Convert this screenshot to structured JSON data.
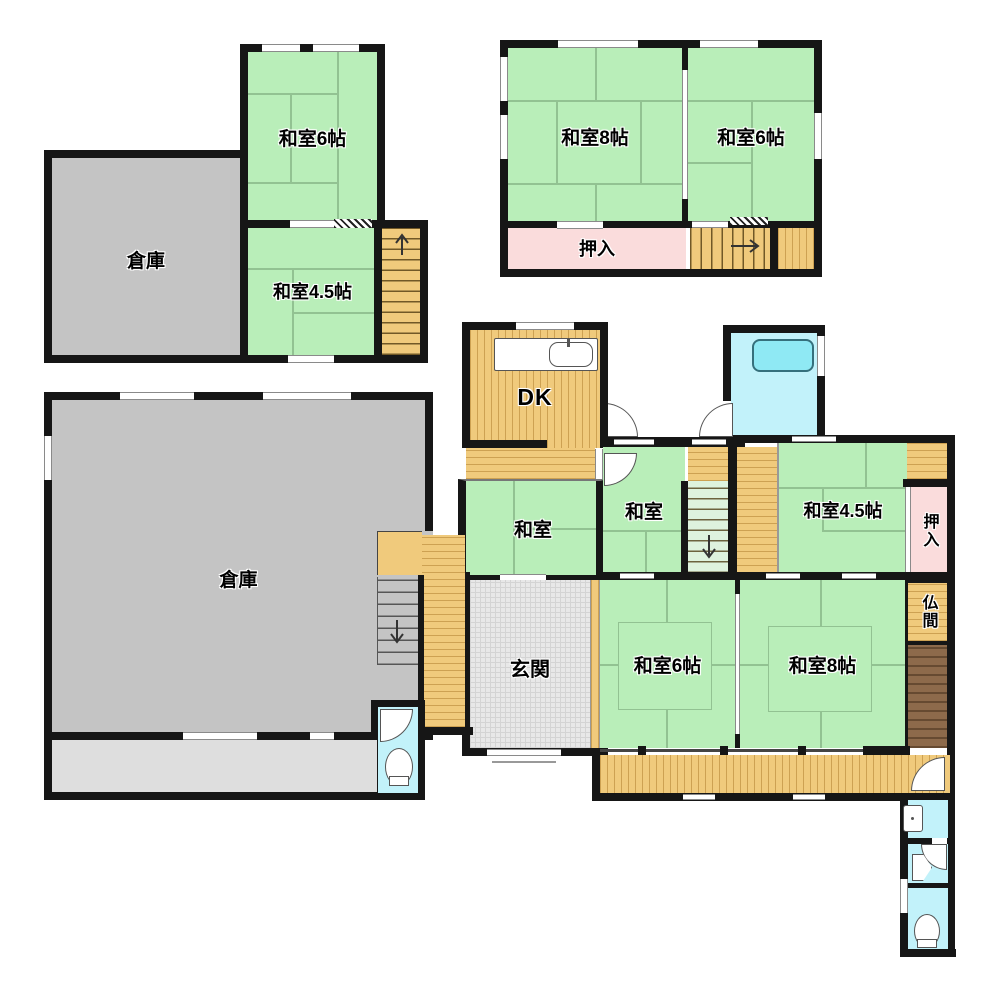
{
  "rooms": {
    "souko_upper": "倉庫",
    "washitsu6_upper": "和室6帖",
    "washitsu45_upper": "和室4.5帖",
    "washitsu8_2f": "和室8帖",
    "washitsu6_2f": "和室6帖",
    "oshiire_2f": "押入",
    "dk": "DK",
    "washitsu_west": "和室",
    "washitsu_center": "和室",
    "washitsu45_mid": "和室4.5帖",
    "oshiire_mid": "押入",
    "butsuma": "仏間",
    "genkan": "玄関",
    "souko_main": "倉庫",
    "washitsu6_lower": "和室6帖",
    "washitsu8_lower": "和室8帖"
  },
  "colors": {
    "wall": "#161616",
    "tatami_green": "#b9eeb9",
    "wood_orange": "#f0ca7c",
    "closet_pink": "#fadcdc",
    "water_cyan": "#c2f2fa",
    "storage_gray": "#c4c4c4",
    "storage_light_gray": "#dedede",
    "entrance_gray": "#e8e8e8",
    "stair_storage_brown": "#8d6a4b",
    "bathtub_cyan": "#8fe9f4"
  }
}
